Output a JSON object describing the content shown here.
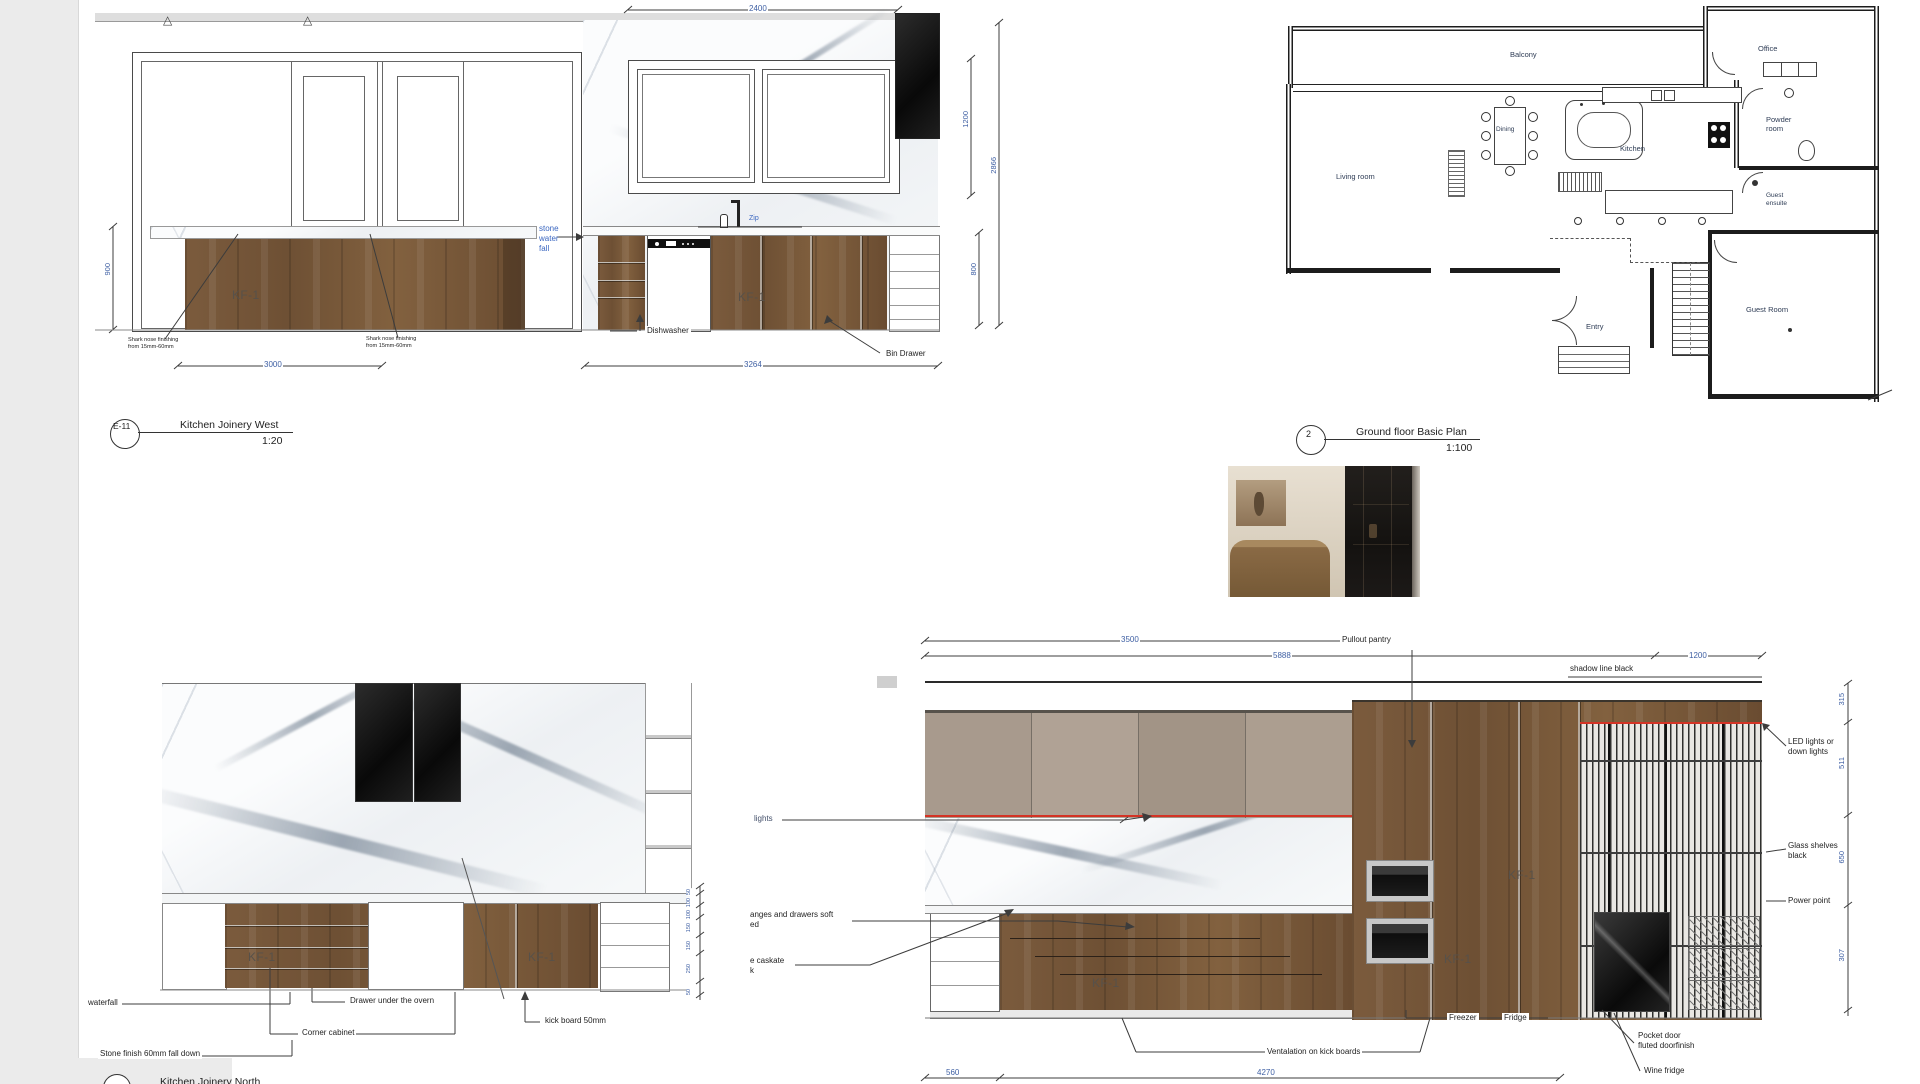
{
  "colors": {
    "dim_text": "#3e5fa3",
    "annotation_blue": "#3a66c0",
    "led_strip_red": "#d43325",
    "wood_panel": "#77573a",
    "taupe_panel": "#a89a8d"
  },
  "west": {
    "marker": "E-11",
    "title": "Kitchen Joinery West",
    "scale": "1:20",
    "kf1": "KF-1",
    "swf": [
      "stone",
      "water",
      "fall"
    ],
    "zip": "Zip",
    "dishwasher": "Dishwasher",
    "bin_drawer": "Bin Drawer",
    "shark": [
      "Shark nose finishing",
      "from 15mm-60mm"
    ],
    "dims": {
      "top": "2400",
      "left_height": "900",
      "bottom_left": "3000",
      "bottom_right": "3264",
      "right_upper": "1200",
      "right_total": "2866",
      "right_lower": "800"
    }
  },
  "plan": {
    "marker": "2",
    "title": "Ground floor Basic Plan",
    "scale": "1:100",
    "balcony": "Balcony",
    "living_room": "Living room",
    "dining": "Dining",
    "kitchen": "Kitchen",
    "office": "Office",
    "powder": [
      "Powder",
      "room"
    ],
    "guest_ensuite": [
      "Guest",
      "ensuite"
    ],
    "guest_room": "Guest Room",
    "entry": "Entry"
  },
  "north": {
    "title": "Kitchen Joinery North",
    "kf1": "KF-1",
    "waterfall": "waterfall",
    "drawer_under": "Drawer under the overn",
    "corner_cabinet": "Corner cabinet",
    "kick_board": "kick board 50mm",
    "stone_finish": "Stone finish 60mm fall down",
    "chain": [
      "50",
      "100",
      "100",
      "150",
      "150",
      "250",
      "50"
    ]
  },
  "big": {
    "kf1": "KF-1",
    "pullout": "Pullout pantry",
    "shadow": "shadow line black",
    "lights": "lights",
    "soft_close": [
      "anges and drawers soft",
      "ed"
    ],
    "caskate": [
      "e caskate",
      "k"
    ],
    "led": [
      "LED lights or",
      "down lights"
    ],
    "glass": [
      "Glass shelves",
      "black"
    ],
    "power": "Power point",
    "freezer": "Freezer",
    "fridge": "Fridge",
    "vent": "Ventalation on kick boards",
    "pocket": [
      "Pocket door",
      "fluted doorfinish"
    ],
    "wine": "Wine fridge",
    "dims": {
      "w3500": "3500",
      "w5888": "5888",
      "w1200": "1200",
      "w560": "560",
      "w4270": "4270"
    },
    "chain": [
      "315",
      "511",
      "650",
      "307"
    ]
  }
}
